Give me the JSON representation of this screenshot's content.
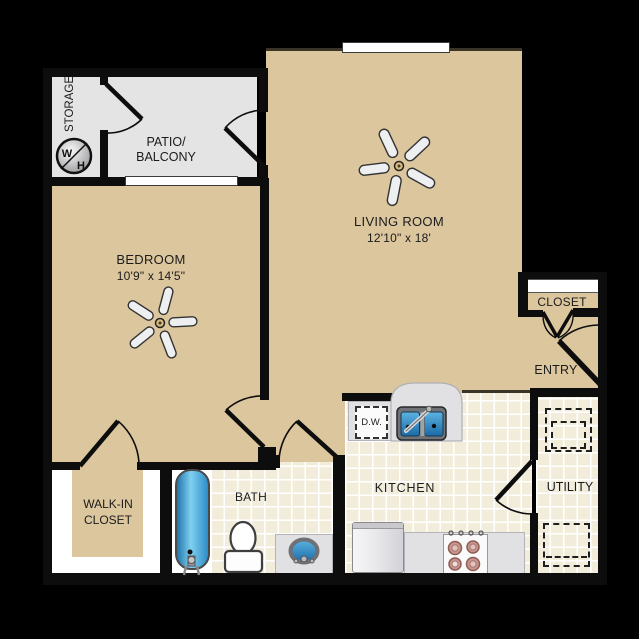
{
  "rooms": {
    "storage": {
      "label": "STORAGE"
    },
    "patio": {
      "label_line1": "PATIO/",
      "label_line2": "BALCONY"
    },
    "bedroom": {
      "label": "BEDROOM",
      "dimensions": "10'9\" x 14'5\""
    },
    "living": {
      "label": "LIVING ROOM",
      "dimensions": "12'10\" x 18'"
    },
    "closet": {
      "label": "CLOSET"
    },
    "entry": {
      "label": "ENTRY"
    },
    "walkin": {
      "label_line1": "WALK-IN",
      "label_line2": "CLOSET"
    },
    "bath": {
      "label": "BATH"
    },
    "kitchen": {
      "label": "KITCHEN"
    },
    "utility": {
      "label": "UTILITY"
    }
  },
  "fixtures": {
    "dishwasher_label": "D.W.",
    "washer_letter": "W",
    "heater_letter": "H"
  },
  "colors": {
    "background": "#000000",
    "floor_tan": "#dcc69e",
    "patio_gray": "#e4e4e4",
    "tile_cream": "#f2ecdb",
    "wall_black": "#0d0d0d",
    "counter_gray": "#e1e1e4",
    "fixture_blue": "#2a85c4",
    "burner_mauve": "#c8968f"
  }
}
